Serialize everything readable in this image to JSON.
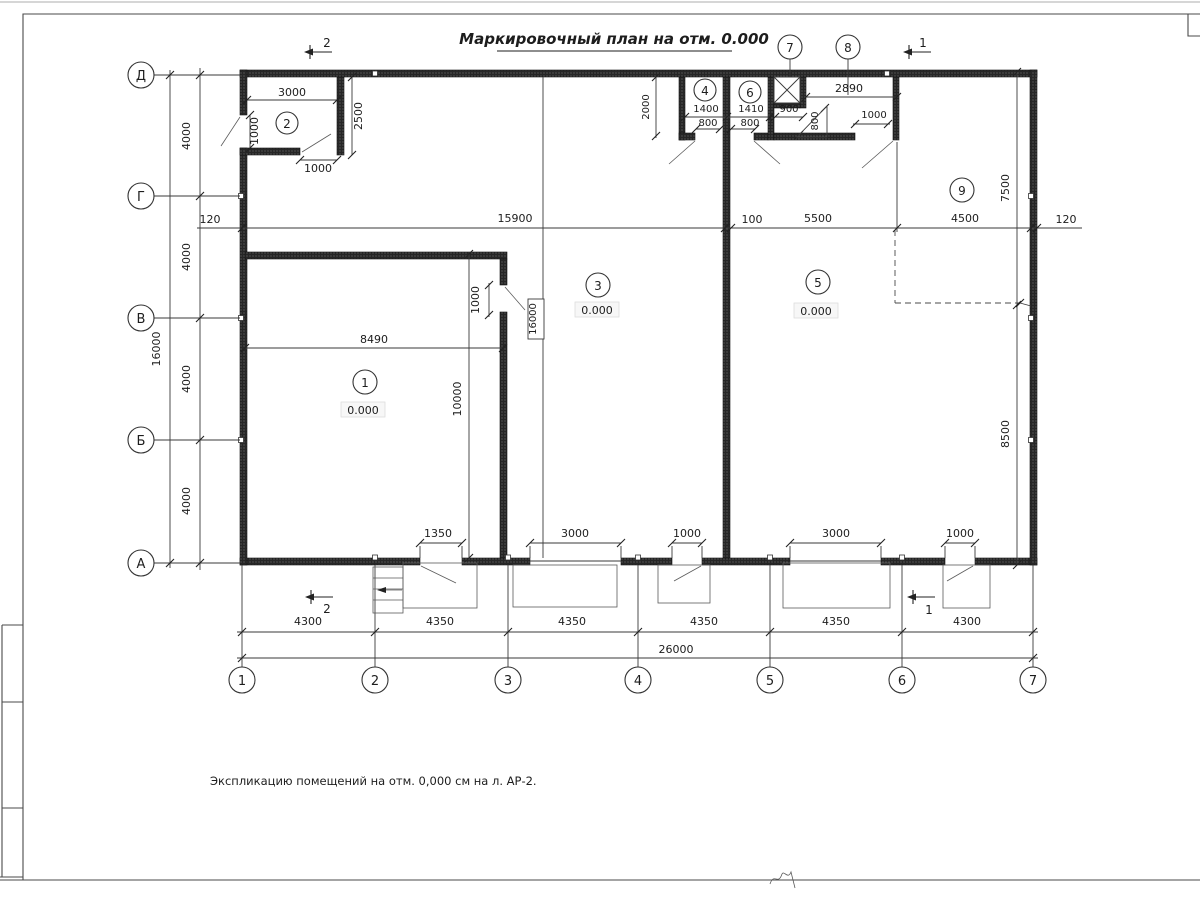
{
  "title": "Маркировочный план на отм. 0.000",
  "note": "Экспликацию помещений на отм. 0,000 см на л. АР-2.",
  "axes": {
    "rows": [
      "Д",
      "Г",
      "В",
      "Б",
      "А"
    ],
    "cols": [
      "1",
      "2",
      "3",
      "4",
      "5",
      "6",
      "7"
    ]
  },
  "rooms": {
    "r1": "1",
    "r2": "2",
    "r3": "3",
    "r4": "4",
    "r5": "5",
    "r6": "6",
    "r7": "7",
    "r8": "8",
    "r9": "9",
    "elevation": "0.000"
  },
  "sections": {
    "s1": "1",
    "s2": "2"
  },
  "dims": {
    "room2_w": "3000",
    "room2_h": "2500",
    "room2_door_left": "1000",
    "room2_door_bottom": "1000",
    "strip_h": "2000",
    "r4_w": "1400",
    "r4_door": "800",
    "r6_w": "1410",
    "r6_door": "800",
    "shaft_w": "900",
    "r8_w": "2890",
    "ramp": "800",
    "r8_door": "1000",
    "main_left": "120",
    "main_span1": "15900",
    "main_gap": "100",
    "main_span2": "5500",
    "main_span3": "4500",
    "main_right": "120",
    "v4000": "4000",
    "v16000": "16000",
    "r9_h": "7500",
    "right_lower": "8500",
    "room1_w": "8490",
    "room1_door": "1000",
    "monorail": "16000",
    "room1_h": "10000",
    "door1": "1350",
    "gate1": "3000",
    "door2": "1000",
    "gate2": "3000",
    "door3": "1000",
    "b1": "4300",
    "b2": "4350",
    "b3": "4350",
    "b4": "4350",
    "b5": "4350",
    "b6": "4300",
    "total": "26000"
  }
}
